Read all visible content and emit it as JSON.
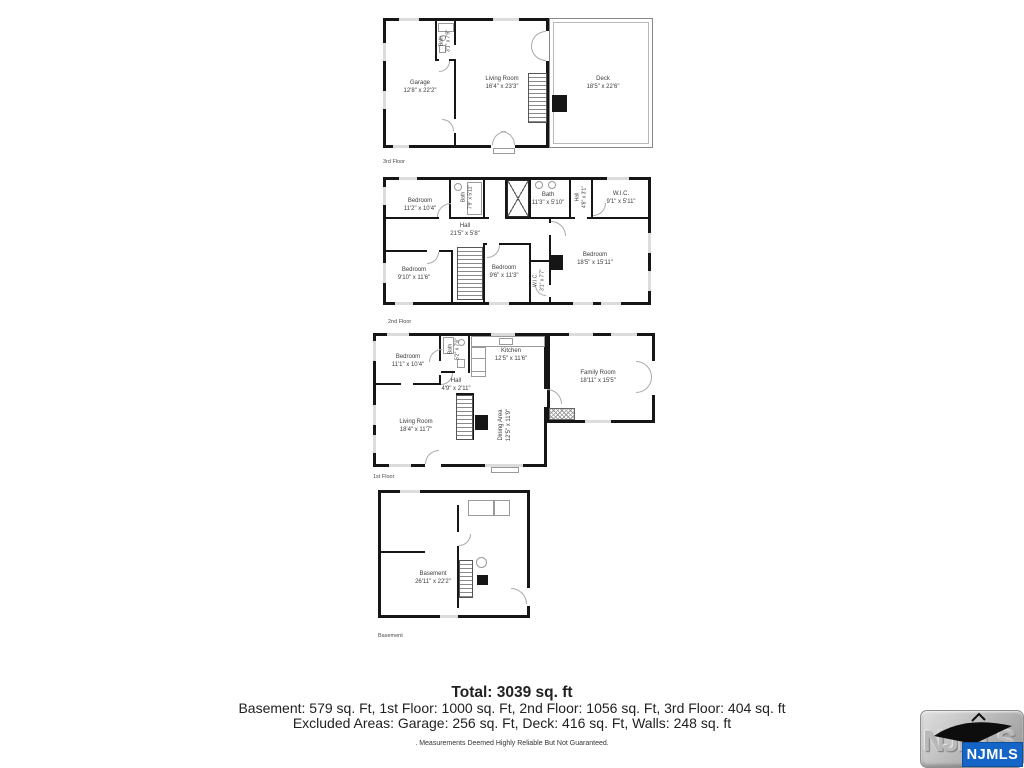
{
  "floors": [
    {
      "label": "3rd Floor",
      "rooms": {
        "garage": {
          "name": "Garage",
          "dims": "12'8\" x 22'2\""
        },
        "living": {
          "name": "Living Room",
          "dims": "16'4\" x 23'3\""
        },
        "deck": {
          "name": "Deck",
          "dims": "18'5\" x 22'6\""
        },
        "bath": {
          "name": "Bath",
          "dims": "3'1\" x 7'9\""
        }
      }
    },
    {
      "label": "2nd Floor",
      "rooms": {
        "bedroom_tl": {
          "name": "Bedroom",
          "dims": "11'2\" x 10'4\""
        },
        "bath_a": {
          "name": "Bath",
          "dims": "7'9\" x 5'11\""
        },
        "bath_b": {
          "name": "Bath",
          "dims": "11'3\" x 5'10\""
        },
        "hall_upper": {
          "name": "Hall",
          "dims": "4'8\" x 3'1\""
        },
        "wic": {
          "name": "W.I.C.",
          "dims": "9'1\" x 5'11\""
        },
        "hall": {
          "name": "Hall",
          "dims": "21'5\" x 5'8\""
        },
        "bedroom_bl": {
          "name": "Bedroom",
          "dims": "9'10\" x 11'6\""
        },
        "bedroom_mid": {
          "name": "Bedroom",
          "dims": "9'6\" x 11'3\""
        },
        "wic_small": {
          "name": "W.I.C.",
          "dims": "3'1\" x 7'7\""
        },
        "bedroom_main": {
          "name": "Bedroom",
          "dims": "18'5\" x 15'11\""
        }
      }
    },
    {
      "label": "1st Floor",
      "rooms": {
        "bedroom": {
          "name": "Bedroom",
          "dims": "11'1\" x 10'4\""
        },
        "bath": {
          "name": "Bath",
          "dims": "5'2\" x 7'6\""
        },
        "kitchen": {
          "name": "Kitchen",
          "dims": "12'5\" x 11'6\""
        },
        "family": {
          "name": "Family Room",
          "dims": "18'11\" x 15'5\""
        },
        "hall": {
          "name": "Hall",
          "dims": "4'9\" x 2'11\""
        },
        "living": {
          "name": "Living Room",
          "dims": "18'4\" x 11'7\""
        },
        "dining": {
          "name": "Dining Area",
          "dims": "12'5\" x 11'9\""
        }
      }
    },
    {
      "label": "Basement",
      "rooms": {
        "basement": {
          "name": "Basement",
          "dims": "26'11\" x 22'2\""
        }
      }
    }
  ],
  "summary": {
    "total": "Total: 3039 sq. ft",
    "floor_areas": "Basement: 579 sq. Ft, 1st Floor: 1000 sq. Ft, 2nd Floor: 1056 sq. Ft, 3rd Floor: 404 sq. ft",
    "excluded_areas": "Excluded Areas: Garage: 256 sq. Ft, Deck: 416 sq. Ft, Walls: 248 sq. ft",
    "disclaimer": ". Measurements Deemed Highly Reliable But Not Guaranteed."
  },
  "logo": {
    "text": "NJMLS",
    "emboss": "NJMLS",
    "blue": "#1565c8"
  },
  "colors": {
    "wall": "#161616",
    "label_text": "#3c3c3c",
    "window_marker": "#dcdcdc"
  }
}
